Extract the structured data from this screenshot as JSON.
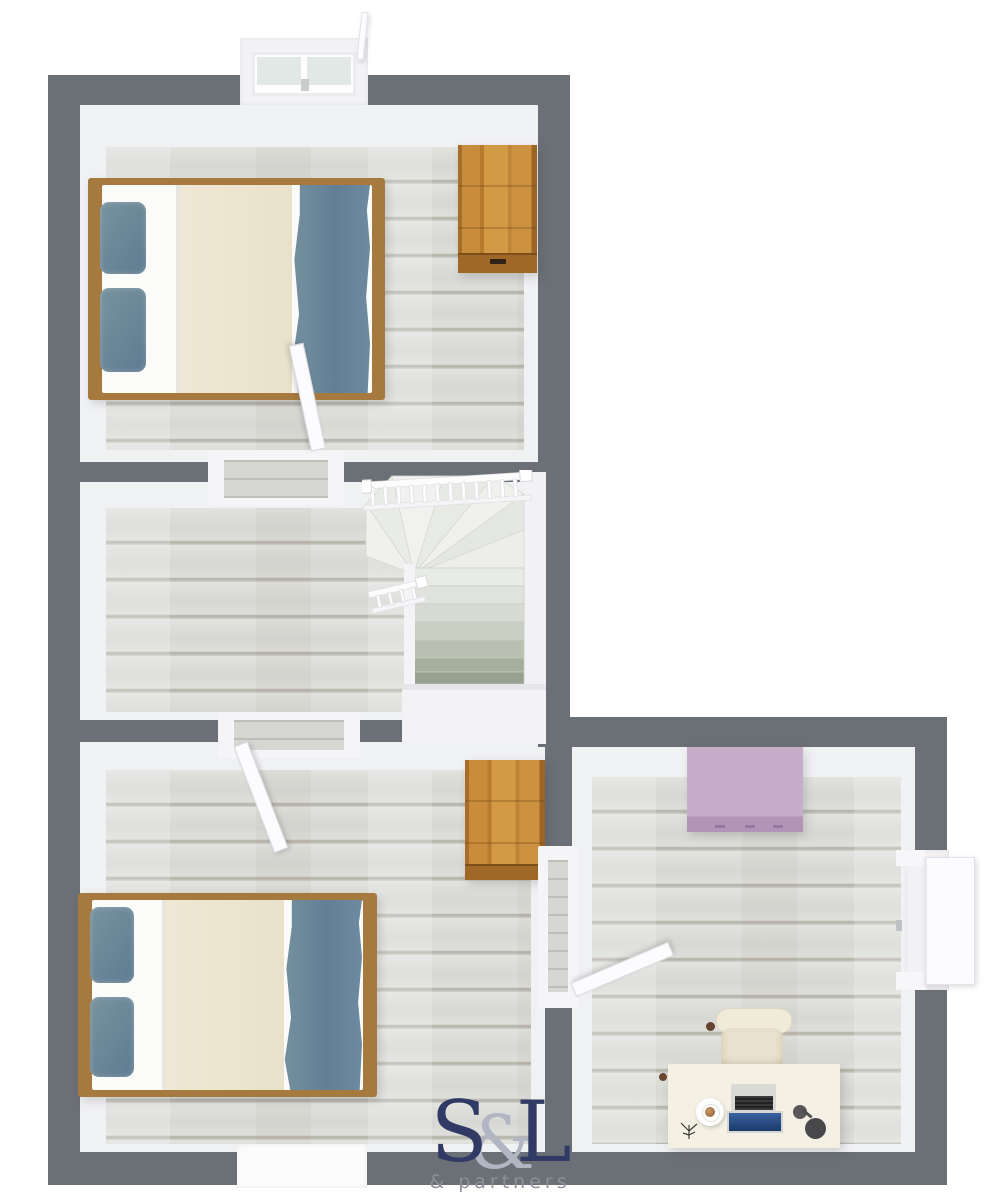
{
  "logo": {
    "part_s": "S",
    "part_amp": "&",
    "part_l": "L",
    "tagline": "& partners"
  },
  "palette": {
    "wall_gray": "#6b7076",
    "floor_wood": "#dcddd9",
    "bed_frame_wood": "#a67a3e",
    "bedding_cream": "#ece4d0",
    "bedding_blue": "#6e8aa0",
    "sheet_white": "#fbfbf9",
    "wardrobe_oak": "#c68c3c",
    "wardrobe_lilac": "#c3aac7",
    "desk_cream": "#f4f1e4",
    "stair_white": "#f6f6f8",
    "logo_navy": "#313a64",
    "logo_gray": "#b2b6c2"
  },
  "rooms": [
    {
      "id": "bedroom-top",
      "furniture": [
        "double-bed",
        "oak-wardrobe",
        "window",
        "door"
      ]
    },
    {
      "id": "landing",
      "furniture": [
        "winder-staircase",
        "railing"
      ]
    },
    {
      "id": "bedroom-bottom",
      "furniture": [
        "double-bed",
        "oak-wardrobe",
        "window",
        "door"
      ]
    },
    {
      "id": "office",
      "furniture": [
        "lilac-wardrobe",
        "desk",
        "office-chair",
        "laptop",
        "coffee-cup",
        "desk-plant",
        "desk-lamp",
        "window",
        "door"
      ]
    }
  ]
}
